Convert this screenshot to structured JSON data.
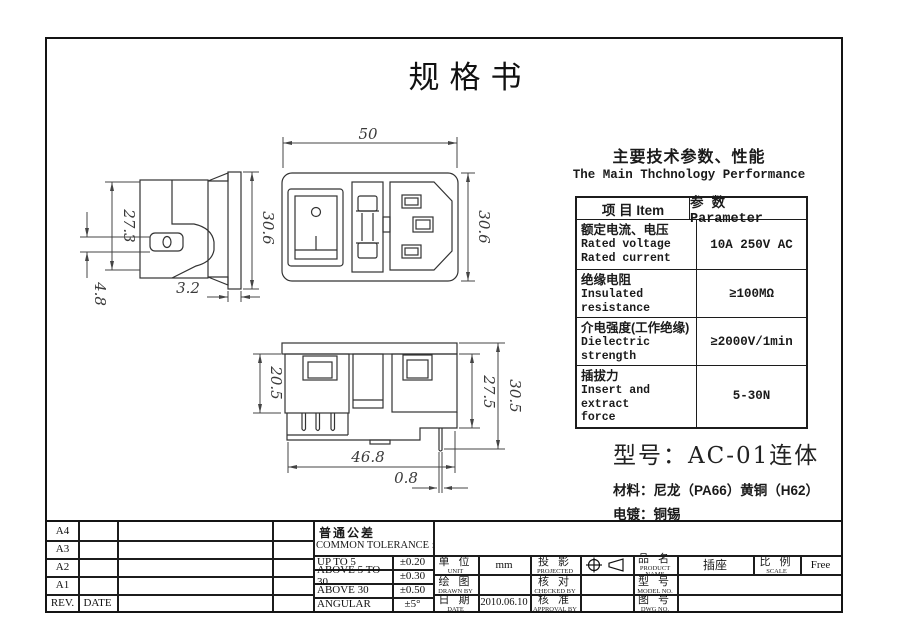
{
  "page": {
    "title": "规格书"
  },
  "tech": {
    "heading_cn": "主要技术参数、性能",
    "heading_en": "The Main Thchnology Performance",
    "table": {
      "col_item": "项 目 Item",
      "col_param": "参 数 Parameter",
      "rows": [
        {
          "cn": "额定电流、电压",
          "en": [
            "Rated voltage",
            "Rated current"
          ],
          "value": "10A 250V AC"
        },
        {
          "cn": "绝缘电阻",
          "en": [
            "Insulated",
            "resistance"
          ],
          "value": "≥100MΩ"
        },
        {
          "cn": "介电强度(工作绝缘)",
          "en": [
            "Dielectric strength"
          ],
          "value": "≥2000V/1min"
        },
        {
          "cn": "插拔力",
          "en": [
            "Insert and extract",
            "force"
          ],
          "value": "5-30N"
        }
      ]
    }
  },
  "product": {
    "model": "型号：AC-01连体",
    "material": "材料：尼龙（PA66）黄铜（H62）",
    "plating": "电镀：铜锡"
  },
  "drawing": {
    "dims": {
      "front_width": "50",
      "front_height": "30.6",
      "side_body_height": "27.3",
      "side_pin": "4.8",
      "flange_thickness": "3.2",
      "side_flange_height": "30.6",
      "bottom_block_height": "20.5",
      "bottom_mid_height": "27.5",
      "bottom_total_height": "30.5",
      "bottom_width": "46.8",
      "terminal_thickness": "0.8"
    }
  },
  "title_block": {
    "revision": {
      "sizes": [
        "A4",
        "A3",
        "A2",
        "A1"
      ],
      "rev": "REV.",
      "date": "DATE"
    },
    "tolerance": {
      "cn": "普通公差",
      "en": "COMMON TOLERANCE :",
      "rows": [
        {
          "range": "UP TO 5",
          "value": "±0.20"
        },
        {
          "range": "ABOVE 5 TO 30",
          "value": "±0.30"
        },
        {
          "range": "ABOVE 30",
          "value": "±0.50"
        },
        {
          "range": "ANGULAR",
          "value": "±5°"
        }
      ]
    },
    "info": {
      "unit": {
        "cn": "单 位",
        "en": "UNIT",
        "value": "mm"
      },
      "projection": {
        "cn": "投 影",
        "en": "PROJECTED"
      },
      "product_name": {
        "cn": "品 名",
        "en": "PRODUCT NAME",
        "value": "插座"
      },
      "scale": {
        "cn": "比 例",
        "en": "SCALE",
        "value": "Free"
      },
      "drawn_by": {
        "cn": "绘 图",
        "en": "DRAWN BY"
      },
      "checked_by": {
        "cn": "核 对",
        "en": "CHECKED BY"
      },
      "model_no": {
        "cn": "型 号",
        "en": "MODEL NO."
      },
      "date": {
        "cn": "日 期",
        "en": "DATE",
        "value": "2010.06.10"
      },
      "approval_by": {
        "cn": "核 准",
        "en": "APPROVAL BY"
      },
      "dwg_no": {
        "cn": "图 号",
        "en": "DWG NO."
      }
    }
  }
}
